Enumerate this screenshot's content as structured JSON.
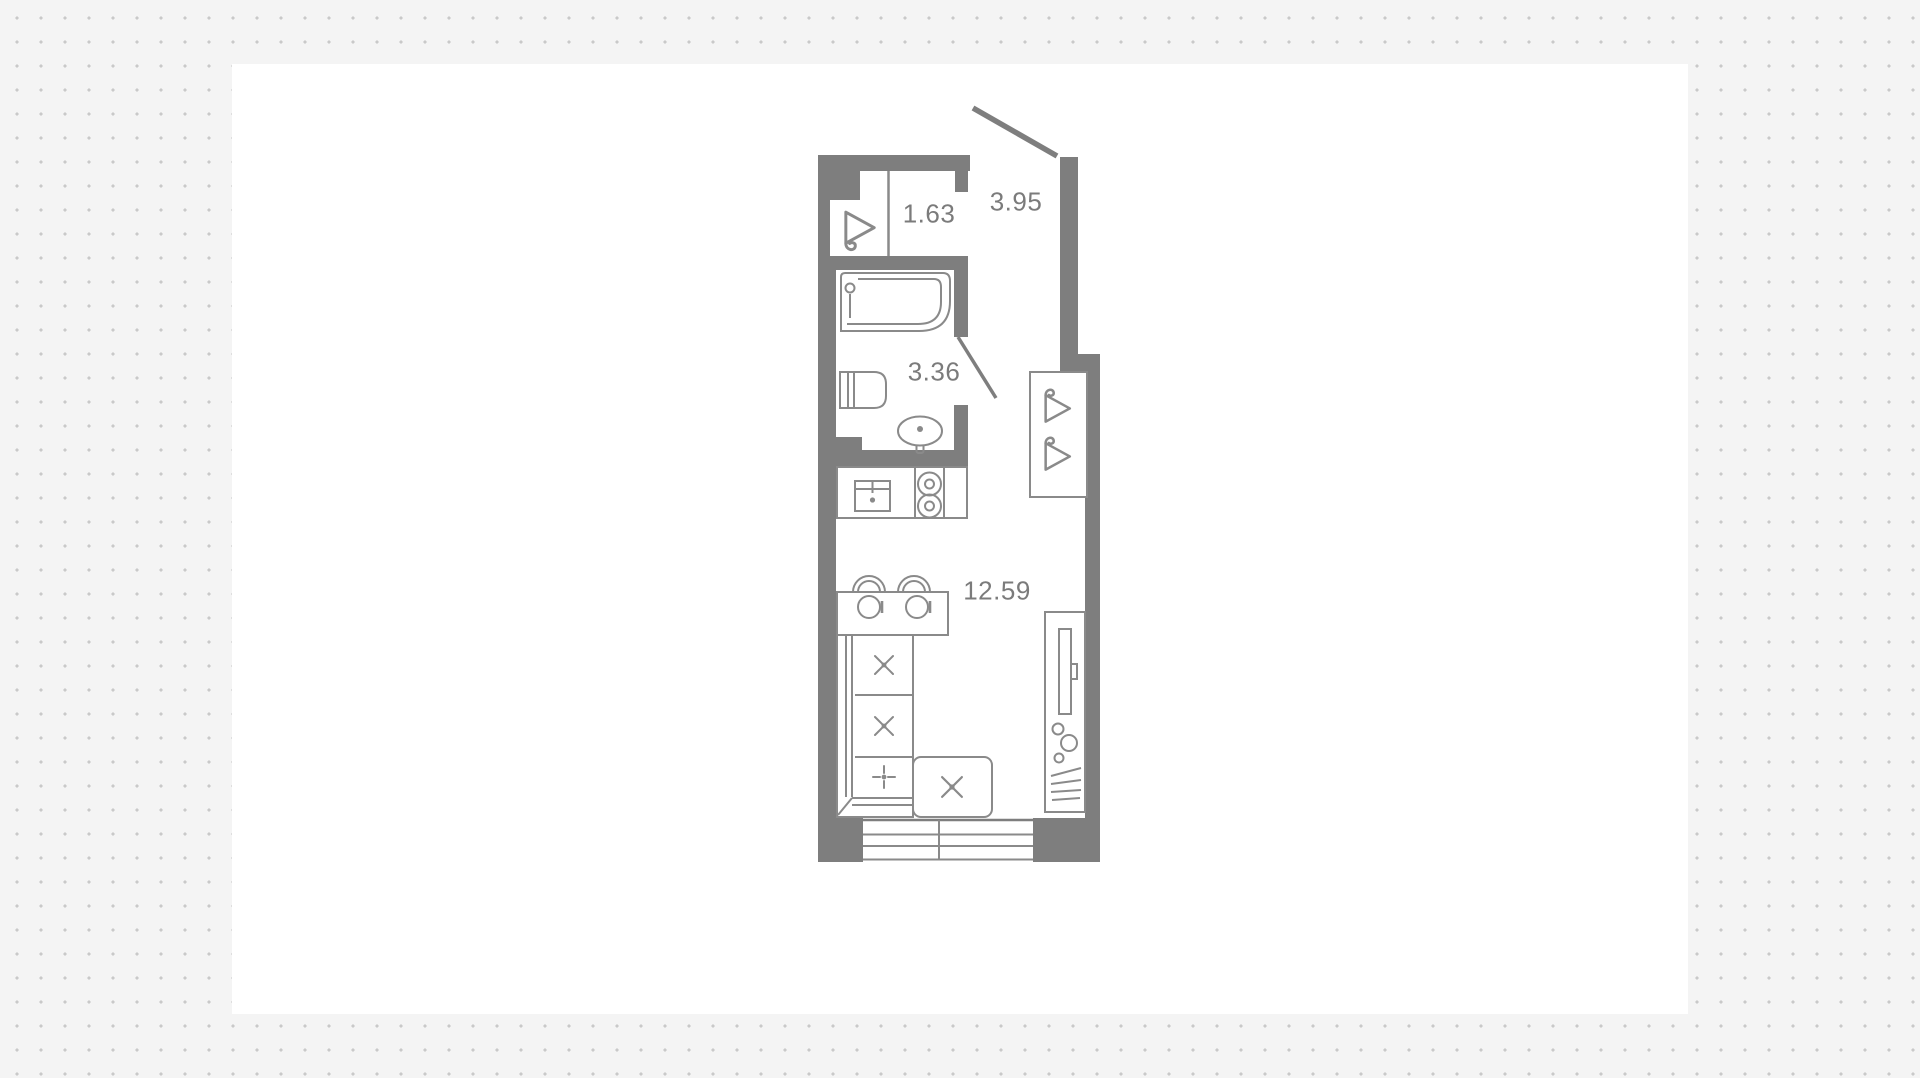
{
  "page": {
    "background": {
      "bg_color": "#f4f4f4",
      "dot_color": "#c9c9c9",
      "dot_spacing_px": 24
    },
    "panel_color": "#ffffff"
  },
  "floorplan": {
    "wall_color": "#7e7e7e",
    "line_color": "#8a8a8a",
    "label_color": "#7b7b7b",
    "rooms": [
      {
        "id": "wardrobe-niche",
        "area_label": "1.63"
      },
      {
        "id": "hallway",
        "area_label": "3.95"
      },
      {
        "id": "bathroom",
        "area_label": "3.36"
      },
      {
        "id": "living-room",
        "area_label": "12.59"
      }
    ],
    "fixtures": [
      "hanger",
      "bathtub",
      "toilet",
      "washbasin",
      "kitchen-sink",
      "stove-2-burners",
      "dining-table",
      "chairs",
      "plates",
      "corner-sofa",
      "ottoman",
      "wardrobe",
      "tv-console",
      "window",
      "entry-door",
      "bathroom-door"
    ]
  }
}
